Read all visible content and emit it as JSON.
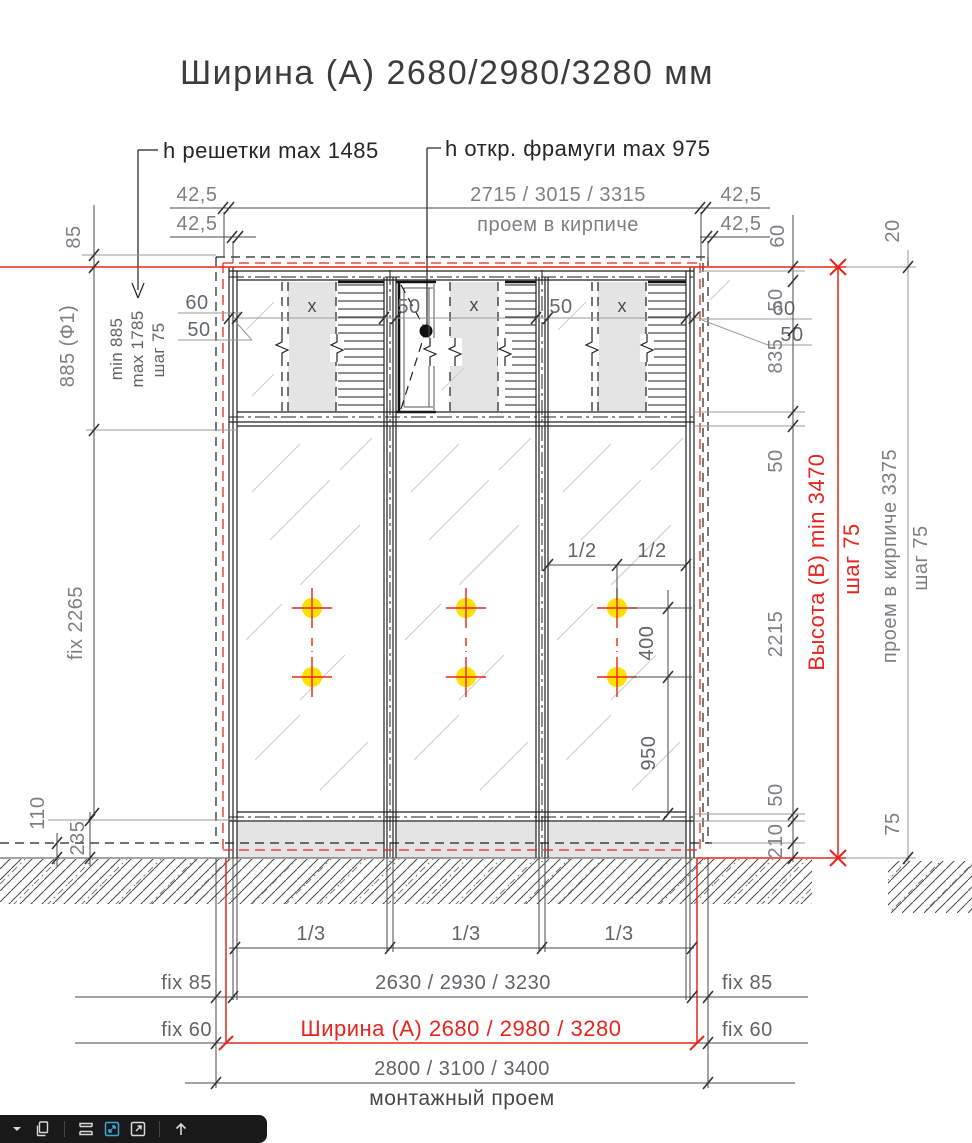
{
  "title": "Ширина (А) 2680/2980/3280 мм",
  "callouts": {
    "grille": "h решетки max 1485",
    "transom": "h откр. фрамуги max 975"
  },
  "dims": {
    "top": {
      "m1l": "42,5",
      "m2l": "42,5",
      "brick_w": "2715 / 3015 / 3315",
      "brick_lbl": "проем в кирпиче",
      "m1r": "42,5",
      "m2r": "42,5",
      "corner": "20",
      "lintel": "85",
      "r60": "60"
    },
    "left": {
      "f1": "885 (Ф1)",
      "min": "min 885",
      "max": "max 1785",
      "step": "шаг 75",
      "fix": "fix 2265",
      "d110": "110",
      "d235": "235"
    },
    "right": {
      "d50a": "50",
      "d835": "835",
      "d50b": "50",
      "d2215": "2215",
      "d50c": "50",
      "d210": "210",
      "d75": "75",
      "height": "Высота (B) min 3470",
      "height_step": "шаг 75",
      "brick_h": "проем в кирпиче 3375",
      "brick_step": "шаг 75"
    },
    "band": {
      "l60": "60",
      "l50": "50",
      "m1": "50",
      "m2": "50",
      "r60": "60",
      "r50": "50",
      "x1": "x",
      "x2": "x",
      "x3": "x"
    },
    "pane": {
      "half_a": "1/2",
      "half_b": "1/2",
      "d400": "400",
      "d950": "950"
    },
    "bottom": {
      "third1": "1/3",
      "third2": "1/3",
      "third3": "1/3",
      "fix85l": "fix 85",
      "fix85r": "fix 85",
      "glass_w": "2630 / 2930 / 3230",
      "fix60l": "fix 60",
      "fix60r": "fix 60",
      "width_a": "Ширина (А) 2680 / 2980 / 3280",
      "mount_w": "2800 / 3100 / 3400",
      "mount_lbl": "монтажный проем"
    }
  },
  "colors": {
    "red": "#e8251c",
    "dim": "#7c8084",
    "dim-dark": "#606468",
    "panel": "#e4e4e4",
    "yellow": "#ffe000",
    "toolbar_bg": "#191919",
    "icon": "#d9d9d9",
    "icon_active": "#38a7de"
  },
  "toolbar": {
    "icons": [
      "dropdown-caret",
      "copy-pages-icon",
      "fit-width-icon",
      "fit-page-active-icon",
      "open-new-window-icon",
      "upload-arrow-icon"
    ]
  }
}
